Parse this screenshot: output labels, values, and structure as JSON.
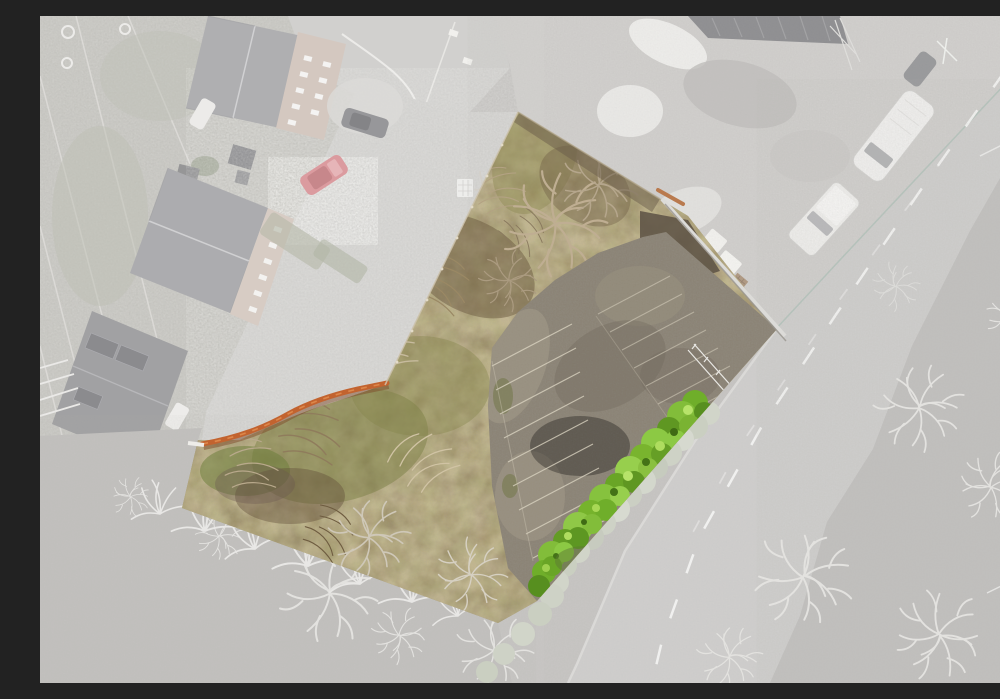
{
  "scene": {
    "alt": "Aerial drone photo of a highlighted vacant plot with overgrown winter scrub and a disused parking area, bordered by an orange boundary wall, a bright green hedge and a main road; surrounding houses, access lane, builders yard, road and fields are shown desaturated grey",
    "elements": [
      "residential-gardens",
      "house-roofs",
      "access-lane",
      "red-car",
      "dark-car",
      "builders-yard",
      "white-van",
      "white-pickup",
      "main-road",
      "roadside-field",
      "frosted-trees",
      "highlighted-plot",
      "scrub-vegetation",
      "disused-parking-area",
      "parking-bay-lines",
      "green-hedge",
      "orange-boundary-wall",
      "retaining-wall",
      "white-railing"
    ]
  },
  "palette": {
    "ground_grey": "#bab8b5",
    "road_grey": "#c3c2c0",
    "road_marking_white": "#f2f2f0",
    "yard_grey": "#c7c5c2",
    "roof_grey": "#9b9b9e",
    "roof_dark": "#848487",
    "facade_warm": "#cabbb1",
    "red_car": "#d28287",
    "white_vehicle": "#edecea",
    "frost_tree": "#dcdbd8",
    "plot_scrub_tan": "#9d8a5f",
    "plot_scrub_dark": "#6b5a3e",
    "plot_grass_olive": "#7c7f46",
    "tarmac_worn": "#8b8375",
    "parking_line": "#d9d2c0",
    "hedge_green": "#79b42e",
    "hedge_green_light": "#8fc847",
    "boundary_orange": "#c2632f",
    "fence_teal": "#9eb3a8",
    "desaturation_veil": "#ffffff"
  }
}
